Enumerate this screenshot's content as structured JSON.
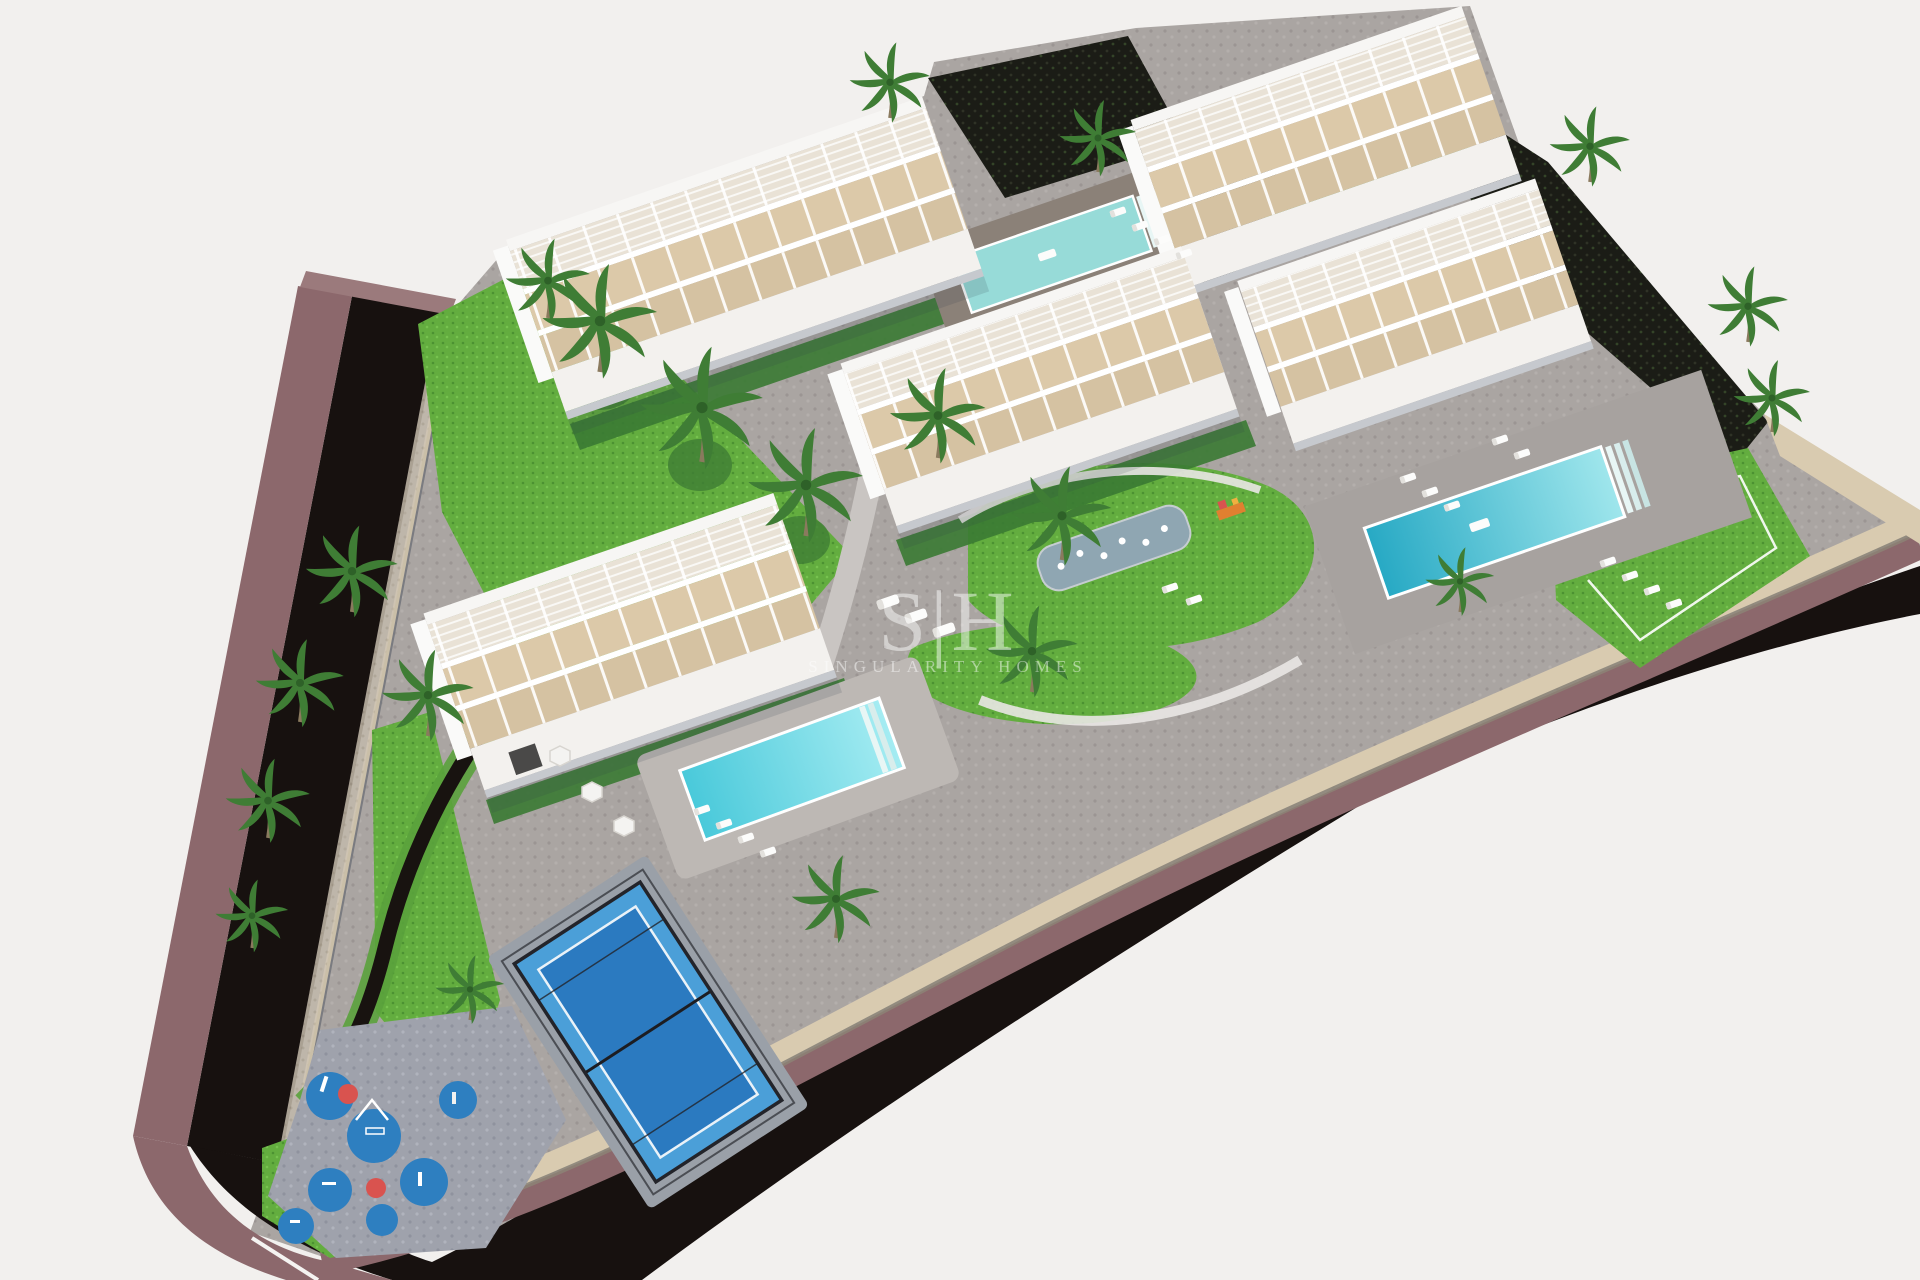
{
  "image": {
    "type": "3d-aerial-architectural-render",
    "subject": "Aerial 3D render of a new-build residential apartment complex with five white apartment blocks, swimming pools, padel court, children's playground, palm trees and a curving perimeter road"
  },
  "watermark": {
    "logo": "S|H",
    "brand": "SINGULARITY HOMES",
    "color": "#ffffff"
  },
  "palette": {
    "background": "#f2f0ee",
    "road_asphalt": "#17110f",
    "road_sidewalk": "#8c686c",
    "road_sidewalk_light": "#9b7a7c",
    "perimeter_wall": "#d9cbb0",
    "site_paving": "#aaa5a2",
    "lawn_green": "#63ad3f",
    "hedge_green": "#3a7a33",
    "palm_green": "#3f7d35",
    "building_white": "#fdfdfc",
    "terrace_beige": "#dbc8a8",
    "pool_aqua_north": "#97dbd8",
    "pool_teal_east": "#2fb4cf",
    "pool_cyan_south": "#49c9da",
    "padel_blue": "#2b7ac0",
    "playground_blue": "#2e7fc0",
    "playground_red": "#d9534f",
    "water_feature_gray": "#8fa6b2",
    "dark_slope": "#1b1c16"
  },
  "scene": {
    "buildings": [
      {
        "name": "top-left apartment block"
      },
      {
        "name": "top-right apartment block"
      },
      {
        "name": "right apartment block"
      },
      {
        "name": "center apartment block"
      },
      {
        "name": "left apartment block"
      }
    ],
    "pools": [
      {
        "name": "north terrace pool"
      },
      {
        "name": "east community pool"
      },
      {
        "name": "south community pool"
      },
      {
        "name": "splash water feature"
      }
    ],
    "amenities": [
      {
        "name": "padel court"
      },
      {
        "name": "children playground"
      },
      {
        "name": "sun loungers"
      },
      {
        "name": "palm trees"
      },
      {
        "name": "perimeter road with sidewalk"
      },
      {
        "name": "stone perimeter wall"
      }
    ]
  }
}
